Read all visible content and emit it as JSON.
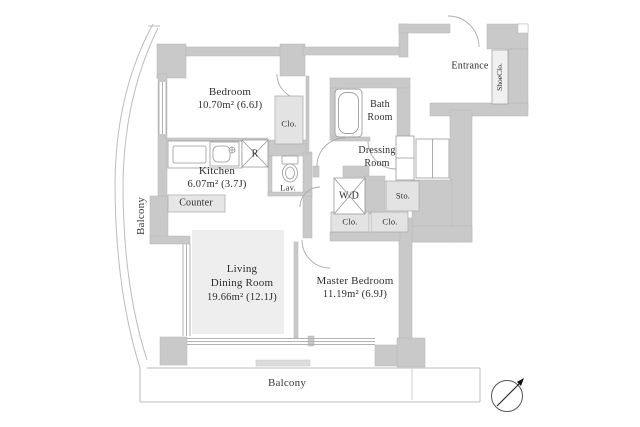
{
  "title": "Apartment floor plan",
  "rooms": {
    "bedroom": {
      "name": "Bedroom",
      "area": "10.70m² (6.6J)"
    },
    "kitchen": {
      "name": "Kitchen",
      "area": "6.07m² (3.7J)"
    },
    "living_dining": {
      "line1": "Living",
      "line2": "Dining Room",
      "area": "19.66m² (12.1J)"
    },
    "master_bedroom": {
      "name": "Master Bedroom",
      "area": "11.19m² (6.9J)"
    },
    "bath": {
      "line1": "Bath",
      "line2": "Room"
    },
    "dressing": {
      "line1": "Dressing",
      "line2": "Room"
    },
    "entrance": {
      "name": "Entrance"
    }
  },
  "labels": {
    "closet_bedroom": "Clo.",
    "closet_hall_left": "Clo.",
    "closet_hall_right": "Clo.",
    "shoe_closet": "ShoeClo.",
    "washer_dryer": "W/D",
    "storage": "Sto.",
    "lavatory": "Lav.",
    "refrigerator": "R",
    "counter": "Counter",
    "balcony_left": "Balcony",
    "balcony_bottom": "Balcony"
  },
  "colors": {
    "wall": "#c9c9c9",
    "light_box": "#e3e3e3",
    "ldk_floor": "#eeeeee",
    "line": "#b3b3b3",
    "text": "#2e2e2e"
  }
}
